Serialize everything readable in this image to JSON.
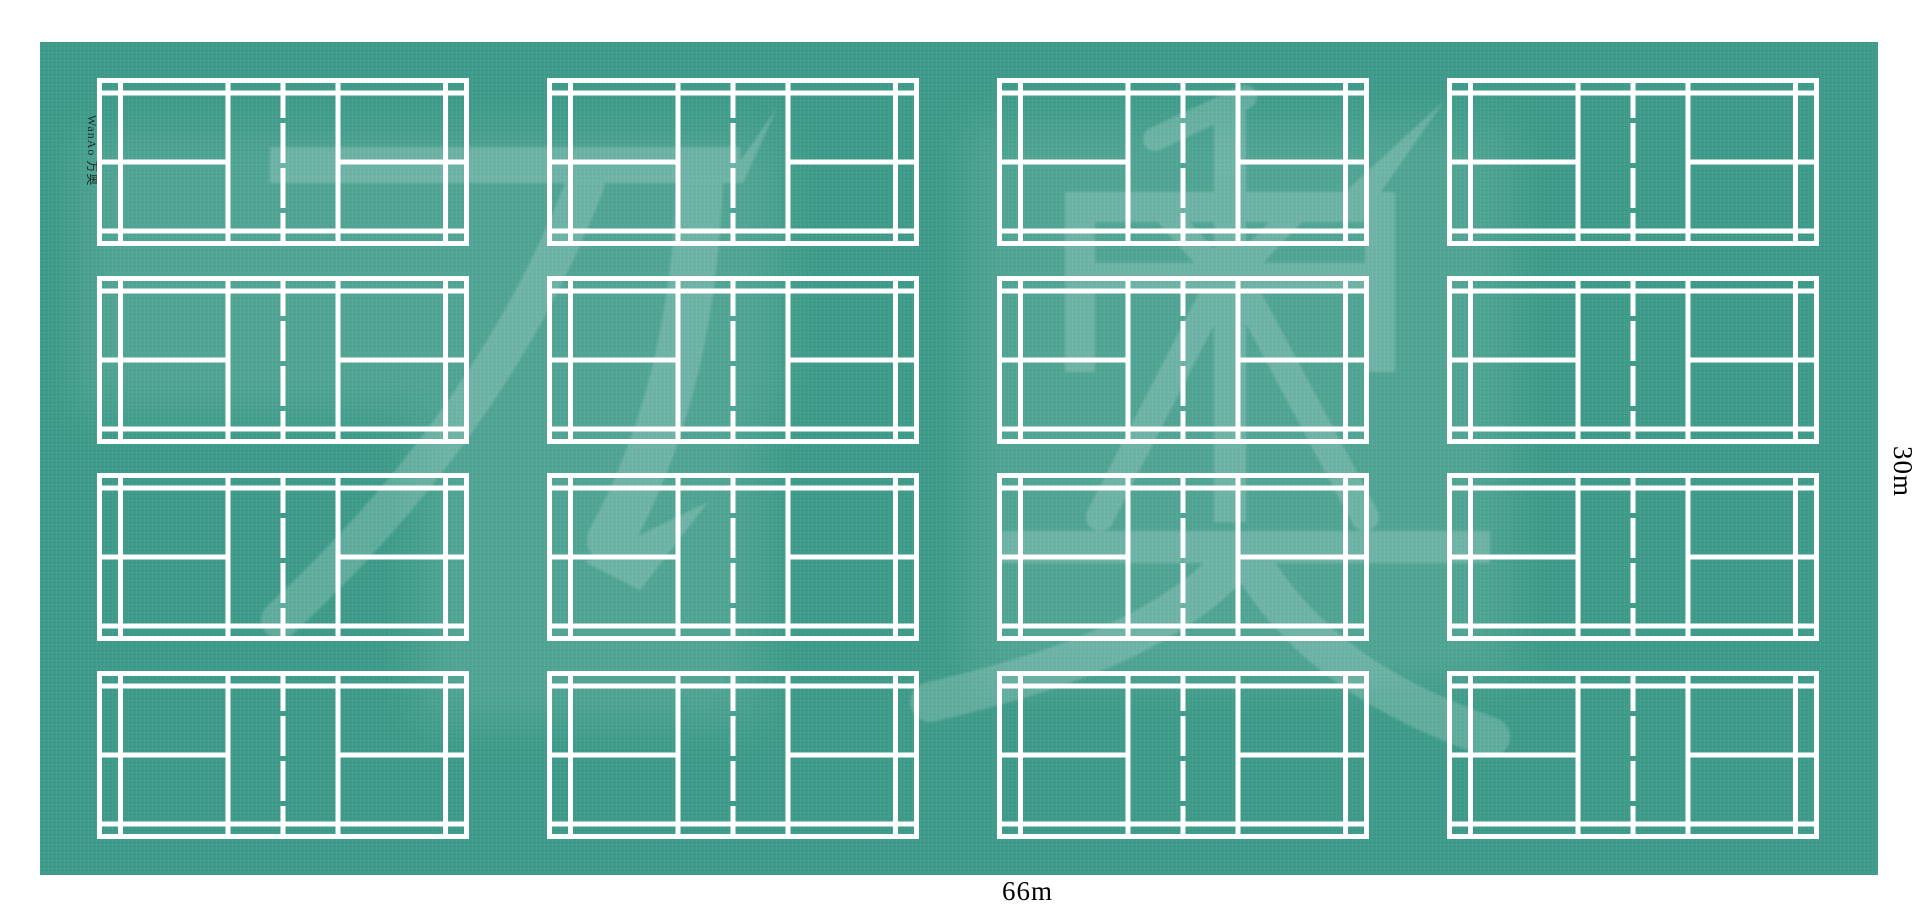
{
  "page": {
    "type": "badminton court flooring layout diagram"
  },
  "floor": {
    "color": "#3f9c8a",
    "line_color": "#ffffff",
    "rows": 4,
    "columns": 4,
    "court_count": 16
  },
  "labels": {
    "width": "66m",
    "height": "30m",
    "brand": "WanAo 万奥",
    "watermark": "万奥"
  }
}
